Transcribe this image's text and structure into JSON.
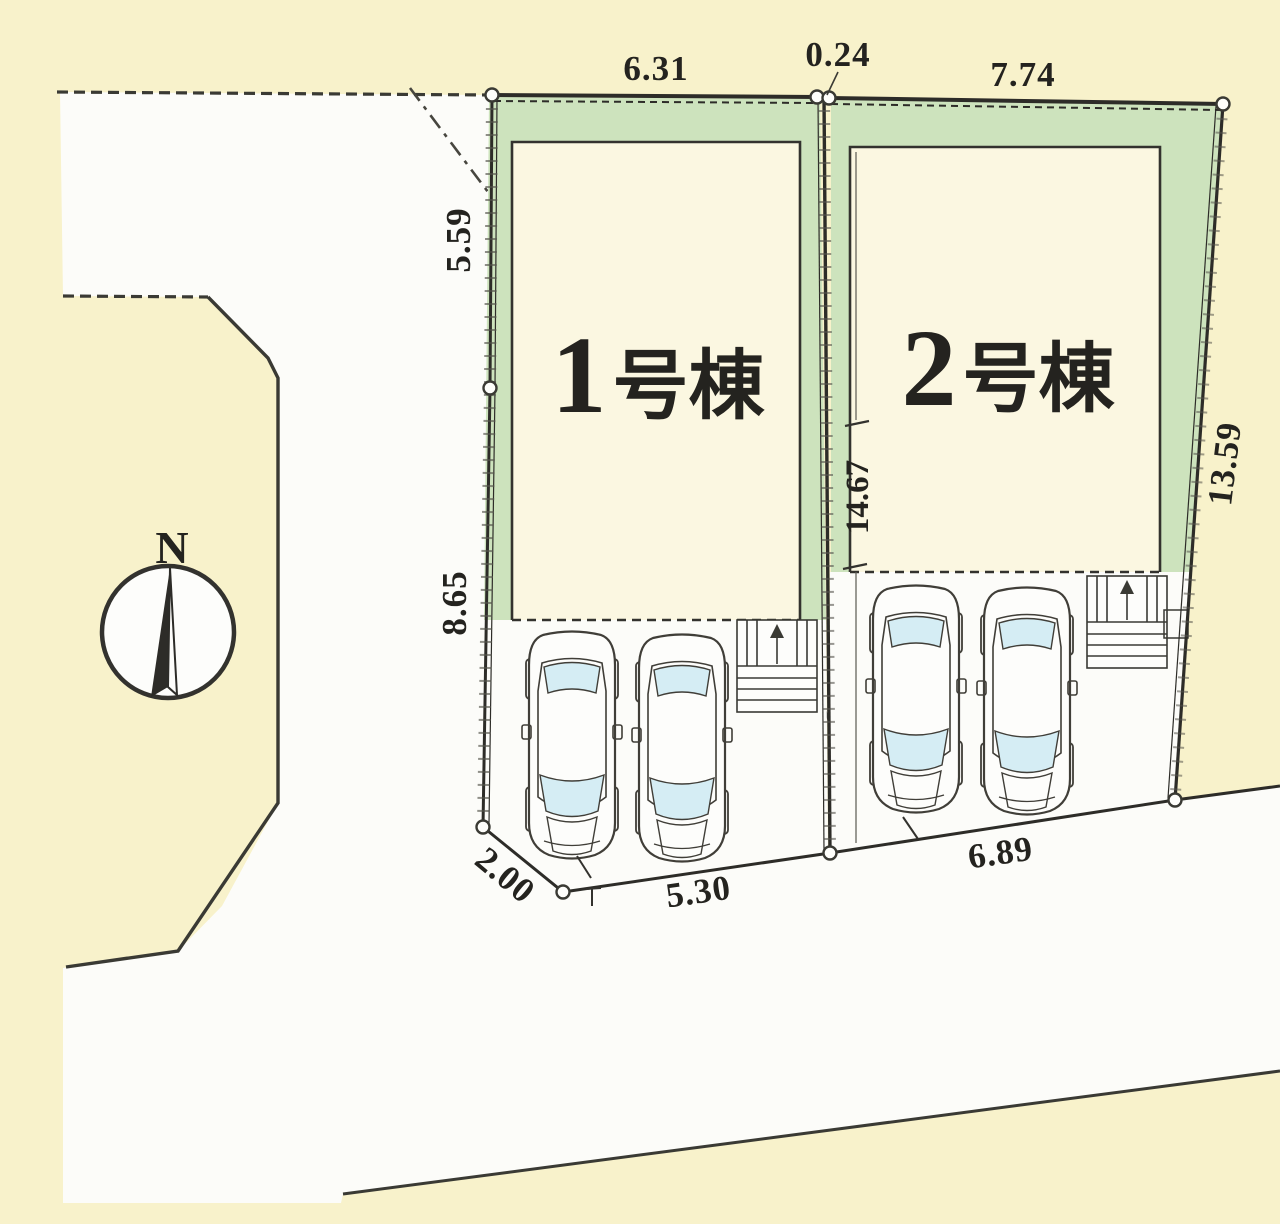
{
  "plan": {
    "type": "site-plan",
    "compass": {
      "north_label": "N"
    },
    "buildings": [
      {
        "id": 1,
        "number": "1",
        "suffix": "号棟"
      },
      {
        "id": 2,
        "number": "2",
        "suffix": "号棟"
      }
    ],
    "dimensions": {
      "top_plot1": "6.31",
      "top_gap": "0.24",
      "top_plot2": "7.74",
      "left_upper": "5.59",
      "left_lower": "8.65",
      "divider": "14.67",
      "right_side": "13.59",
      "bottom_corner": "2.00",
      "bottom_plot1": "5.30",
      "bottom_plot2": "6.89"
    },
    "colors": {
      "background": "#f8f2cb",
      "road": "#fcfcf9",
      "garden_green": "#cde3bd",
      "building_fill": "#fbf7e1",
      "line": "#33322e",
      "car_glass": "#d5edf4"
    }
  }
}
